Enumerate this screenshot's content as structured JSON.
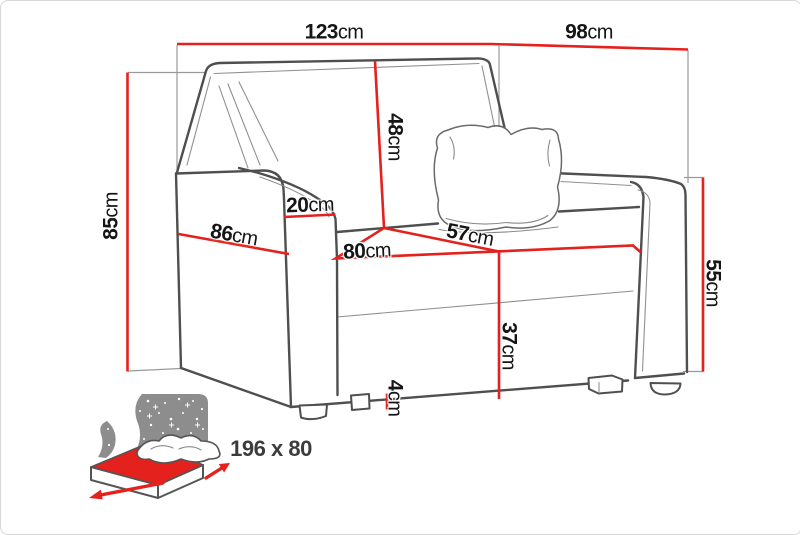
{
  "colors": {
    "accent": "#e4211c",
    "line": "#4f4f4f",
    "label_text": "#151515",
    "icon_gray": "#8d8d8d"
  },
  "dimensions": {
    "top_width": {
      "num": "123",
      "unit": "cm"
    },
    "top_depth": {
      "num": "98",
      "unit": "cm"
    },
    "total_height": {
      "num": "85",
      "unit": "cm"
    },
    "backrest_height": {
      "num": "48",
      "unit": "cm"
    },
    "armrest_width": {
      "num": "20",
      "unit": "cm"
    },
    "armrest_depth": {
      "num": "86",
      "unit": "cm"
    },
    "seat_width": {
      "num": "80",
      "unit": "cm"
    },
    "seat_depth": {
      "num": "57",
      "unit": "cm"
    },
    "seat_height": {
      "num": "37",
      "unit": "cm"
    },
    "armrest_height": {
      "num": "55",
      "unit": "cm"
    },
    "leg_height": {
      "num": "4",
      "unit": "cm"
    }
  },
  "bed_icon": {
    "label": "196 x 80"
  }
}
